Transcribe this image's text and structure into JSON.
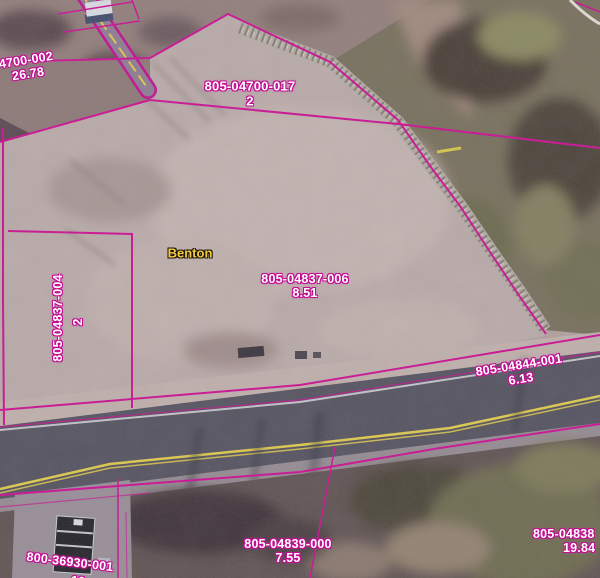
{
  "map": {
    "place_label": "Benton",
    "parcels": {
      "p04700_002": {
        "id": "4700-002",
        "area": "26.78"
      },
      "p04700_017": {
        "id": "805-04700-017",
        "value": "2"
      },
      "p04837_006": {
        "id": "805-04837-006",
        "area": "8.51"
      },
      "p04837_004": {
        "id": "805-04837-004",
        "value": "2"
      },
      "p04844_001": {
        "id": "805-04844-001",
        "area": "6.13"
      },
      "p04839_000": {
        "id": "805-04839-000",
        "area": "7.55"
      },
      "p04838": {
        "id": "805-04838",
        "area": "19.84"
      },
      "p36930_001": {
        "id": "800-36930-001",
        "area": "10"
      }
    },
    "colors": {
      "parcel_line": "#cf0c95",
      "label_text": "#ffffff",
      "place_text": "#f2cc3d",
      "road_centerline": "#e3cf4b"
    }
  }
}
